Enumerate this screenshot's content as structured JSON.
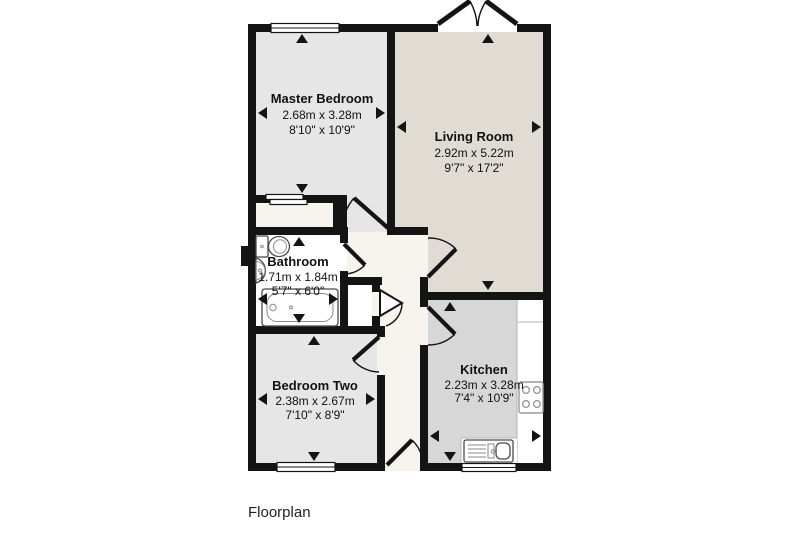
{
  "floorplan": {
    "caption": "Floorplan",
    "rooms": {
      "master_bedroom": {
        "name": "Master Bedroom",
        "metric": "2.68m x 3.28m",
        "imperial": "8'10\" x 10'9\""
      },
      "living_room": {
        "name": "Living Room",
        "metric": "2.92m x 5.22m",
        "imperial": "9'7\" x 17'2\""
      },
      "bathroom": {
        "name": "Bathroom",
        "metric": "1.71m x 1.84m",
        "imperial": "5'7\" x 6'0\""
      },
      "bedroom_two": {
        "name": "Bedroom Two",
        "metric": "2.38m x 2.67m",
        "imperial": "7'10\" x 8'9\""
      },
      "kitchen": {
        "name": "Kitchen",
        "metric": "2.23m x 3.28m",
        "imperial": "7'4\" x 10'9\""
      }
    },
    "colors": {
      "wall": "#141414",
      "bedroom_floor": "#e6e6e6",
      "living_floor": "#e0dcd3",
      "kitchen_floor": "#d7d7d7",
      "hallway_floor": "#f7f4ed",
      "bathroom_floor": "#ffffff"
    }
  }
}
